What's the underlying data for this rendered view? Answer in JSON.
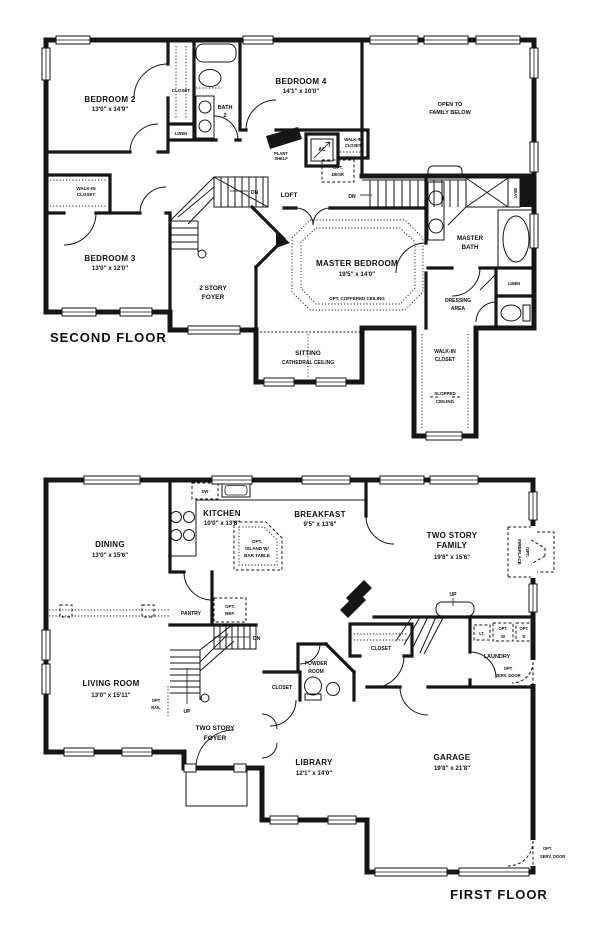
{
  "document": {
    "background": "#ffffff",
    "ink": "#161616"
  },
  "second_floor": {
    "title": "SECOND FLOOR",
    "bedroom2": {
      "name": "BEDROOM 2",
      "dims": "13'0\" x 14'9\""
    },
    "bedroom2_closet": "CLOSET",
    "bath2": {
      "l1": "BATH",
      "l2": "2"
    },
    "linen_hall": "LINEN",
    "bedroom4": {
      "name": "BEDROOM 4",
      "dims": "14'1\" x 10'0\""
    },
    "open_below": {
      "l1": "OPEN TO",
      "l2": "FAMILY BELOW"
    },
    "walkin_left": {
      "l1": "WALK-IN",
      "l2": "CLOSET"
    },
    "bedroom3": {
      "name": "BEDROOM 3",
      "dims": "13'0\" x 12'0\""
    },
    "foyer": {
      "l1": "2 STORY",
      "l2": "FOYER"
    },
    "plant_shelf": {
      "l1": "PLANT",
      "l2": "SHELF"
    },
    "ac": "AC",
    "walkin_b4": {
      "l1": "WALK-IN",
      "l2": "CLOSET"
    },
    "opt_desk": {
      "l1": "OPT.",
      "l2": "DESK"
    },
    "dn_left": "DN",
    "loft": "LOFT",
    "dn_right": "DN",
    "seat": "SEAT",
    "master_bedroom": {
      "name": "MASTER BEDROOM",
      "dims": "19'5\" x 14'0\"",
      "ceiling": "OPT. COFFERED CEILING"
    },
    "master_bath": {
      "l1": "MASTER",
      "l2": "BATH"
    },
    "dressing": {
      "l1": "DRESSING",
      "l2": "AREA"
    },
    "linen_master": "LINEN",
    "sitting": {
      "name": "SITTING",
      "ceiling": "CATHEDRAL CEILING"
    },
    "walkin_master": {
      "l1": "WALK-IN",
      "l2": "CLOSET"
    },
    "slopped": {
      "l1": "SLOPPED",
      "l2": "CEILING"
    }
  },
  "first_floor": {
    "title": "FIRST FLOOR",
    "dw": "DW",
    "kitchen": {
      "name": "KITCHEN",
      "dims": "10'0\" x 13'8\""
    },
    "breakfast": {
      "name": "BREAKFAST",
      "dims": "9'5\" x 13'8\""
    },
    "island": {
      "l1": "OPT.",
      "l2": "ISLAND W/",
      "l3": "BAR TABLE"
    },
    "family": {
      "l1": "TWO STORY",
      "l2": "FAMILY",
      "dims": "19'6\" x 15'6\""
    },
    "fireplace": {
      "l1": "OPT.",
      "l2": "FIREPLACE"
    },
    "dining": {
      "name": "DINING",
      "dims": "13'0\" x 15'6\""
    },
    "pantry": "PANTRY",
    "opt_ref": {
      "l1": "OPT.",
      "l2": "REF."
    },
    "dn": "DN",
    "up_main": "UP",
    "opt_rail": {
      "l1": "OPT",
      "l2": "RAIL"
    },
    "up_back": "UP",
    "closet_hall": "CLOSET",
    "lt": "LT.",
    "opt_w": {
      "l1": "OPT.",
      "l2": "W"
    },
    "opt_d": {
      "l1": "OPT.",
      "l2": "D"
    },
    "laundry": "LAUNDRY",
    "serv_laundry": {
      "l1": "OPT",
      "l2": "SERV. DOOR"
    },
    "living": {
      "name": "LIVING ROOM",
      "dims": "13'0\" x 15'11\""
    },
    "foyer": {
      "l1": "TWO STORY",
      "l2": "FOYER"
    },
    "powder": {
      "l1": "POWDER",
      "l2": "ROOM"
    },
    "closet_foyer": "CLOSET",
    "library": {
      "name": "LIBRARY",
      "dims": "12'1\" x 14'0\""
    },
    "garage": {
      "name": "GARAGE",
      "dims": "19'8\" x 21'8\""
    },
    "serv_garage": {
      "l1": "OPT.",
      "l2": "SERV. DOOR"
    }
  }
}
